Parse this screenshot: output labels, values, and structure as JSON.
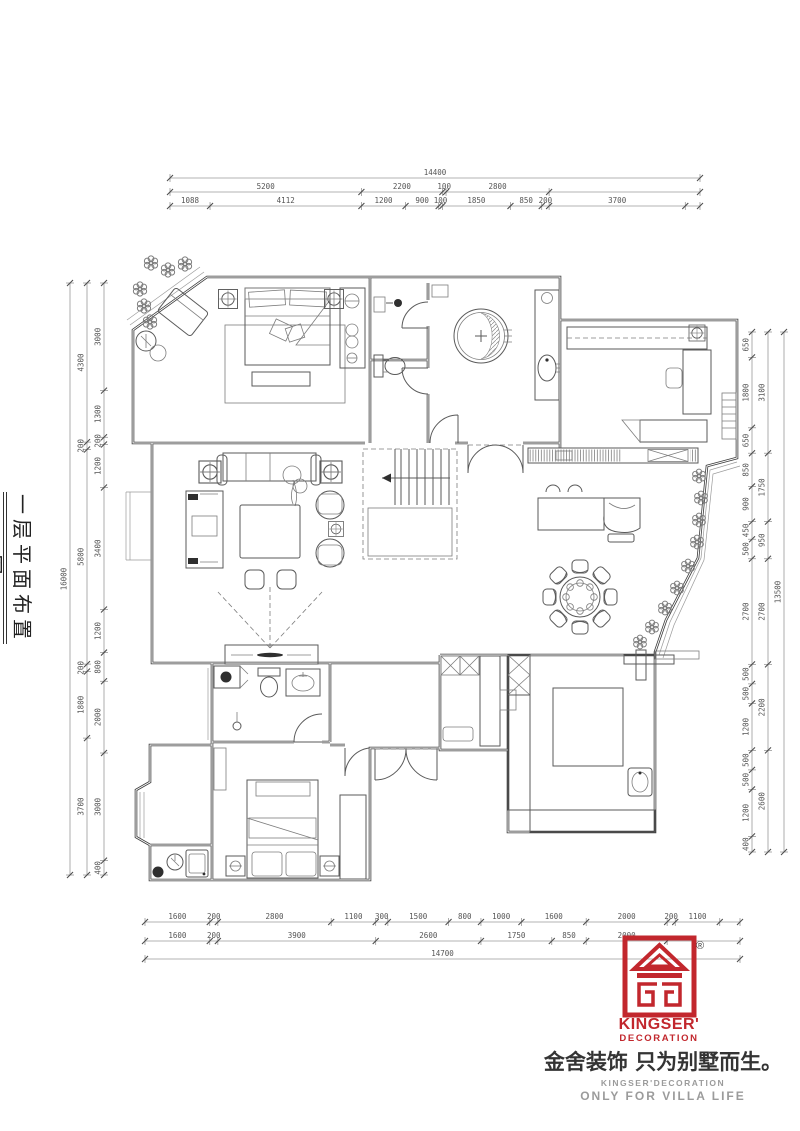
{
  "title": {
    "text": "一层平面布置图"
  },
  "logo": {
    "registered": "®",
    "brand_line1": "KINGSER'",
    "brand_line2": "DECORATION",
    "slogan_cn": "金舍装饰 只为别墅而生。",
    "slogan_en1": "KINGSER'DECORATION",
    "slogan_en2": "ONLY FOR VILLA LIFE",
    "red": "#c2272d",
    "gray": "#9b9b9b"
  },
  "dims": {
    "top": {
      "row1": [
        [
          14400,
          "14400"
        ]
      ],
      "row2": [
        [
          5200,
          "5200"
        ],
        [
          2200,
          "2200"
        ],
        [
          100,
          "100"
        ],
        [
          2800,
          "2800"
        ],
        [
          4100,
          ""
        ]
      ],
      "row3": [
        [
          1088,
          "1088"
        ],
        [
          4112,
          "4112"
        ],
        [
          1200,
          "1200"
        ],
        [
          900,
          "900"
        ],
        [
          100,
          "100"
        ],
        [
          1850,
          "1850"
        ],
        [
          850,
          "850"
        ],
        [
          200,
          "200"
        ],
        [
          3700,
          "3700"
        ],
        [
          400,
          ""
        ]
      ]
    },
    "bottom": {
      "row1": [
        [
          1600,
          "1600"
        ],
        [
          200,
          "200"
        ],
        [
          2800,
          "2800"
        ],
        [
          1100,
          "1100"
        ],
        [
          300,
          "300"
        ],
        [
          1500,
          "1500"
        ],
        [
          800,
          "800"
        ],
        [
          1000,
          "1000"
        ],
        [
          1600,
          "1600"
        ],
        [
          2000,
          "2000"
        ],
        [
          200,
          "200"
        ],
        [
          1100,
          "1100"
        ],
        [
          500,
          ""
        ]
      ],
      "row2": [
        [
          1600,
          "1600"
        ],
        [
          200,
          "200"
        ],
        [
          3900,
          "3900"
        ],
        [
          2600,
          "2600"
        ],
        [
          1750,
          "1750"
        ],
        [
          850,
          "850"
        ],
        [
          2000,
          "2000"
        ],
        [
          1800,
          ""
        ]
      ],
      "row3": [
        [
          14700,
          "14700"
        ]
      ]
    },
    "left": {
      "inner": [
        [
          3000,
          "3000"
        ],
        [
          1300,
          "1300"
        ],
        [
          200,
          "200"
        ],
        [
          1200,
          "1200"
        ],
        [
          3400,
          "3400"
        ],
        [
          1200,
          "1200"
        ],
        [
          800,
          "800"
        ],
        [
          2000,
          "2000"
        ],
        [
          3000,
          "3000"
        ],
        [
          400,
          "400"
        ]
      ],
      "middle": [
        [
          4300,
          "4300"
        ],
        [
          200,
          "200"
        ],
        [
          5800,
          "5800"
        ],
        [
          200,
          "200"
        ],
        [
          1800,
          "1800"
        ],
        [
          3700,
          "3700"
        ]
      ],
      "outer": [
        [
          16000,
          "16000"
        ]
      ]
    },
    "right": {
      "inner": [
        [
          650,
          "650"
        ],
        [
          1800,
          "1800"
        ],
        [
          650,
          "650"
        ],
        [
          850,
          "850"
        ],
        [
          900,
          "900"
        ],
        [
          450,
          "450"
        ],
        [
          500,
          "500"
        ],
        [
          2700,
          "2700"
        ],
        [
          500,
          "500"
        ],
        [
          500,
          "500"
        ],
        [
          1200,
          "1200"
        ],
        [
          500,
          "500"
        ],
        [
          500,
          "500"
        ],
        [
          1200,
          "1200"
        ],
        [
          400,
          "400"
        ]
      ],
      "outer": [
        [
          3100,
          "3100"
        ],
        [
          1750,
          "1750"
        ],
        [
          950,
          "950"
        ],
        [
          2700,
          "2700"
        ],
        [
          2200,
          "2200"
        ],
        [
          2600,
          "2600"
        ]
      ],
      "total": [
        [
          13500,
          "13500"
        ]
      ]
    }
  }
}
